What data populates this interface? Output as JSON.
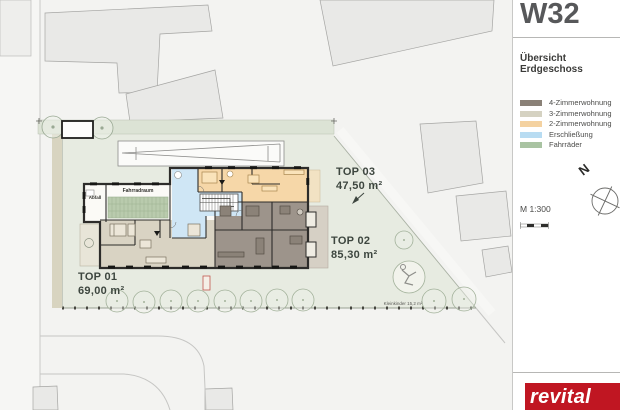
{
  "header": {
    "project_code": "W32",
    "subtitle": "Übersicht Erdgeschoss"
  },
  "legend": {
    "items": [
      {
        "label": "4-Zimmerwohnung",
        "color": "#8a8177"
      },
      {
        "label": "3-Zimmerwohnung",
        "color": "#d5d2c2"
      },
      {
        "label": "2-Zimmerwohnung",
        "color": "#f4d2a1"
      },
      {
        "label": "Erschließung",
        "color": "#b8dcf2"
      },
      {
        "label": "Fahrräder",
        "color": "#a9c3a2"
      }
    ]
  },
  "map": {
    "north_label": "N",
    "scale_label": "M 1:300"
  },
  "plan": {
    "units": [
      {
        "id": "TOP 01",
        "area": "69,00 m²",
        "color": "#d9d3c3"
      },
      {
        "id": "TOP 02",
        "area": "85,30 m²",
        "color": "#9d948b"
      },
      {
        "id": "TOP 03",
        "area": "47,50 m²",
        "color": "#f6d7a8"
      }
    ],
    "labels": {
      "bike_room": "Fahrradraum",
      "waste_room": "Abfall",
      "playground": "Kleinkinder 15,2 m²"
    }
  },
  "branding": {
    "logo_text": "revital",
    "logo_color": "#c01622"
  }
}
